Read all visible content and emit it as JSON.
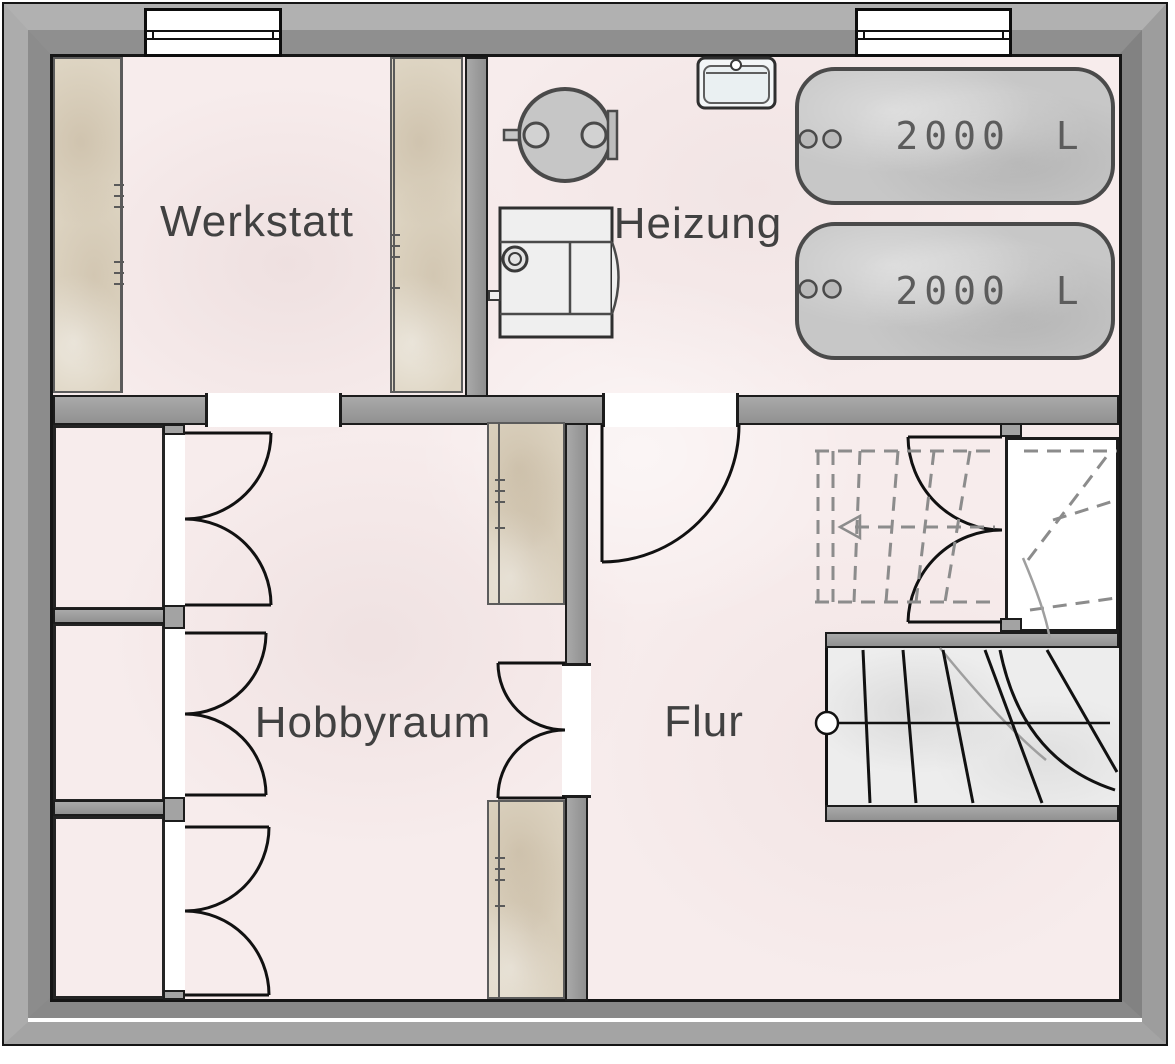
{
  "rooms": [
    {
      "name": "Werkstatt"
    },
    {
      "name": "Heizung"
    },
    {
      "name": "Hobbyraum"
    },
    {
      "name": "Flur"
    }
  ],
  "equipment": {
    "tanks": [
      {
        "capacity": "2000 L"
      },
      {
        "capacity": "2000 L"
      }
    ]
  },
  "colors": {
    "outer_wall": "#9d9d9d",
    "inner_wall": "#a0a0a0",
    "floor": "#f7ecec",
    "cabinet": "#ded5c3",
    "tank_fill": "#c7c7c7",
    "line": "#1c1c1c",
    "dashed_stair": "#8c8c8c",
    "label_text": "#414141",
    "tank_text": "#5c5c5c"
  }
}
